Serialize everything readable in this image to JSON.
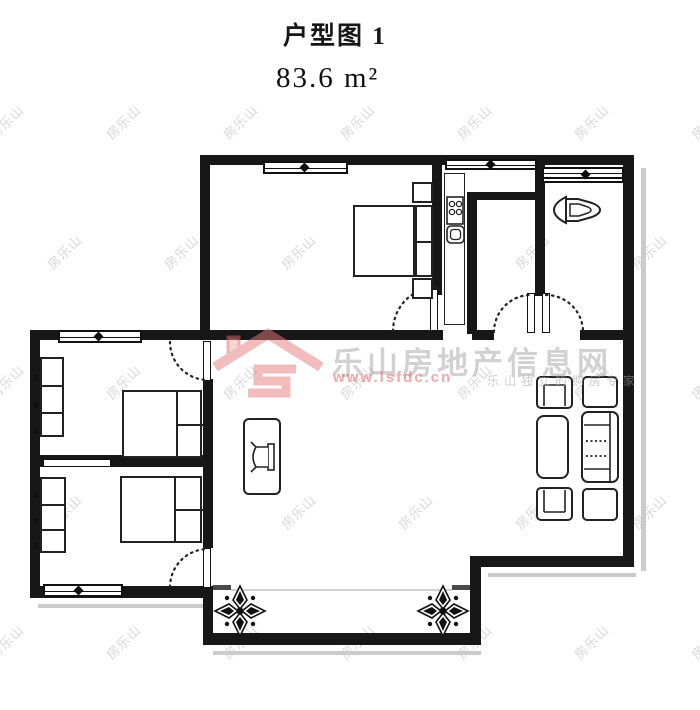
{
  "header": {
    "title": "户型图 1",
    "area": "83.6 m²"
  },
  "watermark": {
    "tile_text": "房乐山",
    "brand": "乐山房地产信息网",
    "url": "www.lsfdc.cn",
    "tagline": "乐山独立的购房专家",
    "accent_color": "#e06a6a",
    "gray_color": "#9a9a9a"
  },
  "plan": {
    "wall_color": "#171717",
    "shadow_color": "#cbcbcb",
    "furniture_icons": [
      "double-bed-icon",
      "wardrobe-icon",
      "tv-cabinet-icon",
      "sofa-icon",
      "armchair-icon",
      "coffee-table-icon",
      "side-table-icon",
      "toilet-icon",
      "stove-icon",
      "sink-icon",
      "window-icon",
      "door-arc-icon",
      "flower-ornament-icon"
    ]
  }
}
